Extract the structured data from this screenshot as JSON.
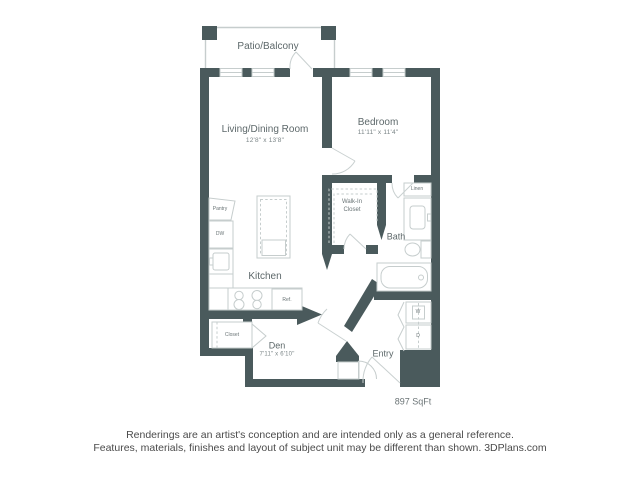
{
  "plan": {
    "patio": {
      "label": "Patio/Balcony"
    },
    "living": {
      "label": "Living/Dining Room",
      "dims": "12'8\" x 13'8\""
    },
    "bedroom": {
      "label": "Bedroom",
      "dims": "11'11\" x 11'4\""
    },
    "walk_in_closet": {
      "label": "Walk-In\nCloset"
    },
    "bath": {
      "label": "Bath"
    },
    "linen": {
      "label": "Linen"
    },
    "kitchen": {
      "label": "Kitchen",
      "pantry": "Pantry",
      "dishwasher": "DW",
      "refrigerator": "Ref."
    },
    "den": {
      "label": "Den",
      "dims": "7'11\" x 6'10\"",
      "closet": "Closet"
    },
    "entry": {
      "label": "Entry",
      "washer": "W",
      "dryer": "D"
    },
    "area": "897 SqFt"
  },
  "footer": {
    "line1": "Renderings are an artist's conception and are intended only as a general reference.",
    "line2": "Features, materials, finishes and layout of subject unit may be different than shown. 3DPlans.com"
  },
  "colors": {
    "wall": "#4a5a5c",
    "fixture_line": "#c6cdcd",
    "room_label": "#5d686a",
    "footer_text": "#4b4b4b"
  }
}
